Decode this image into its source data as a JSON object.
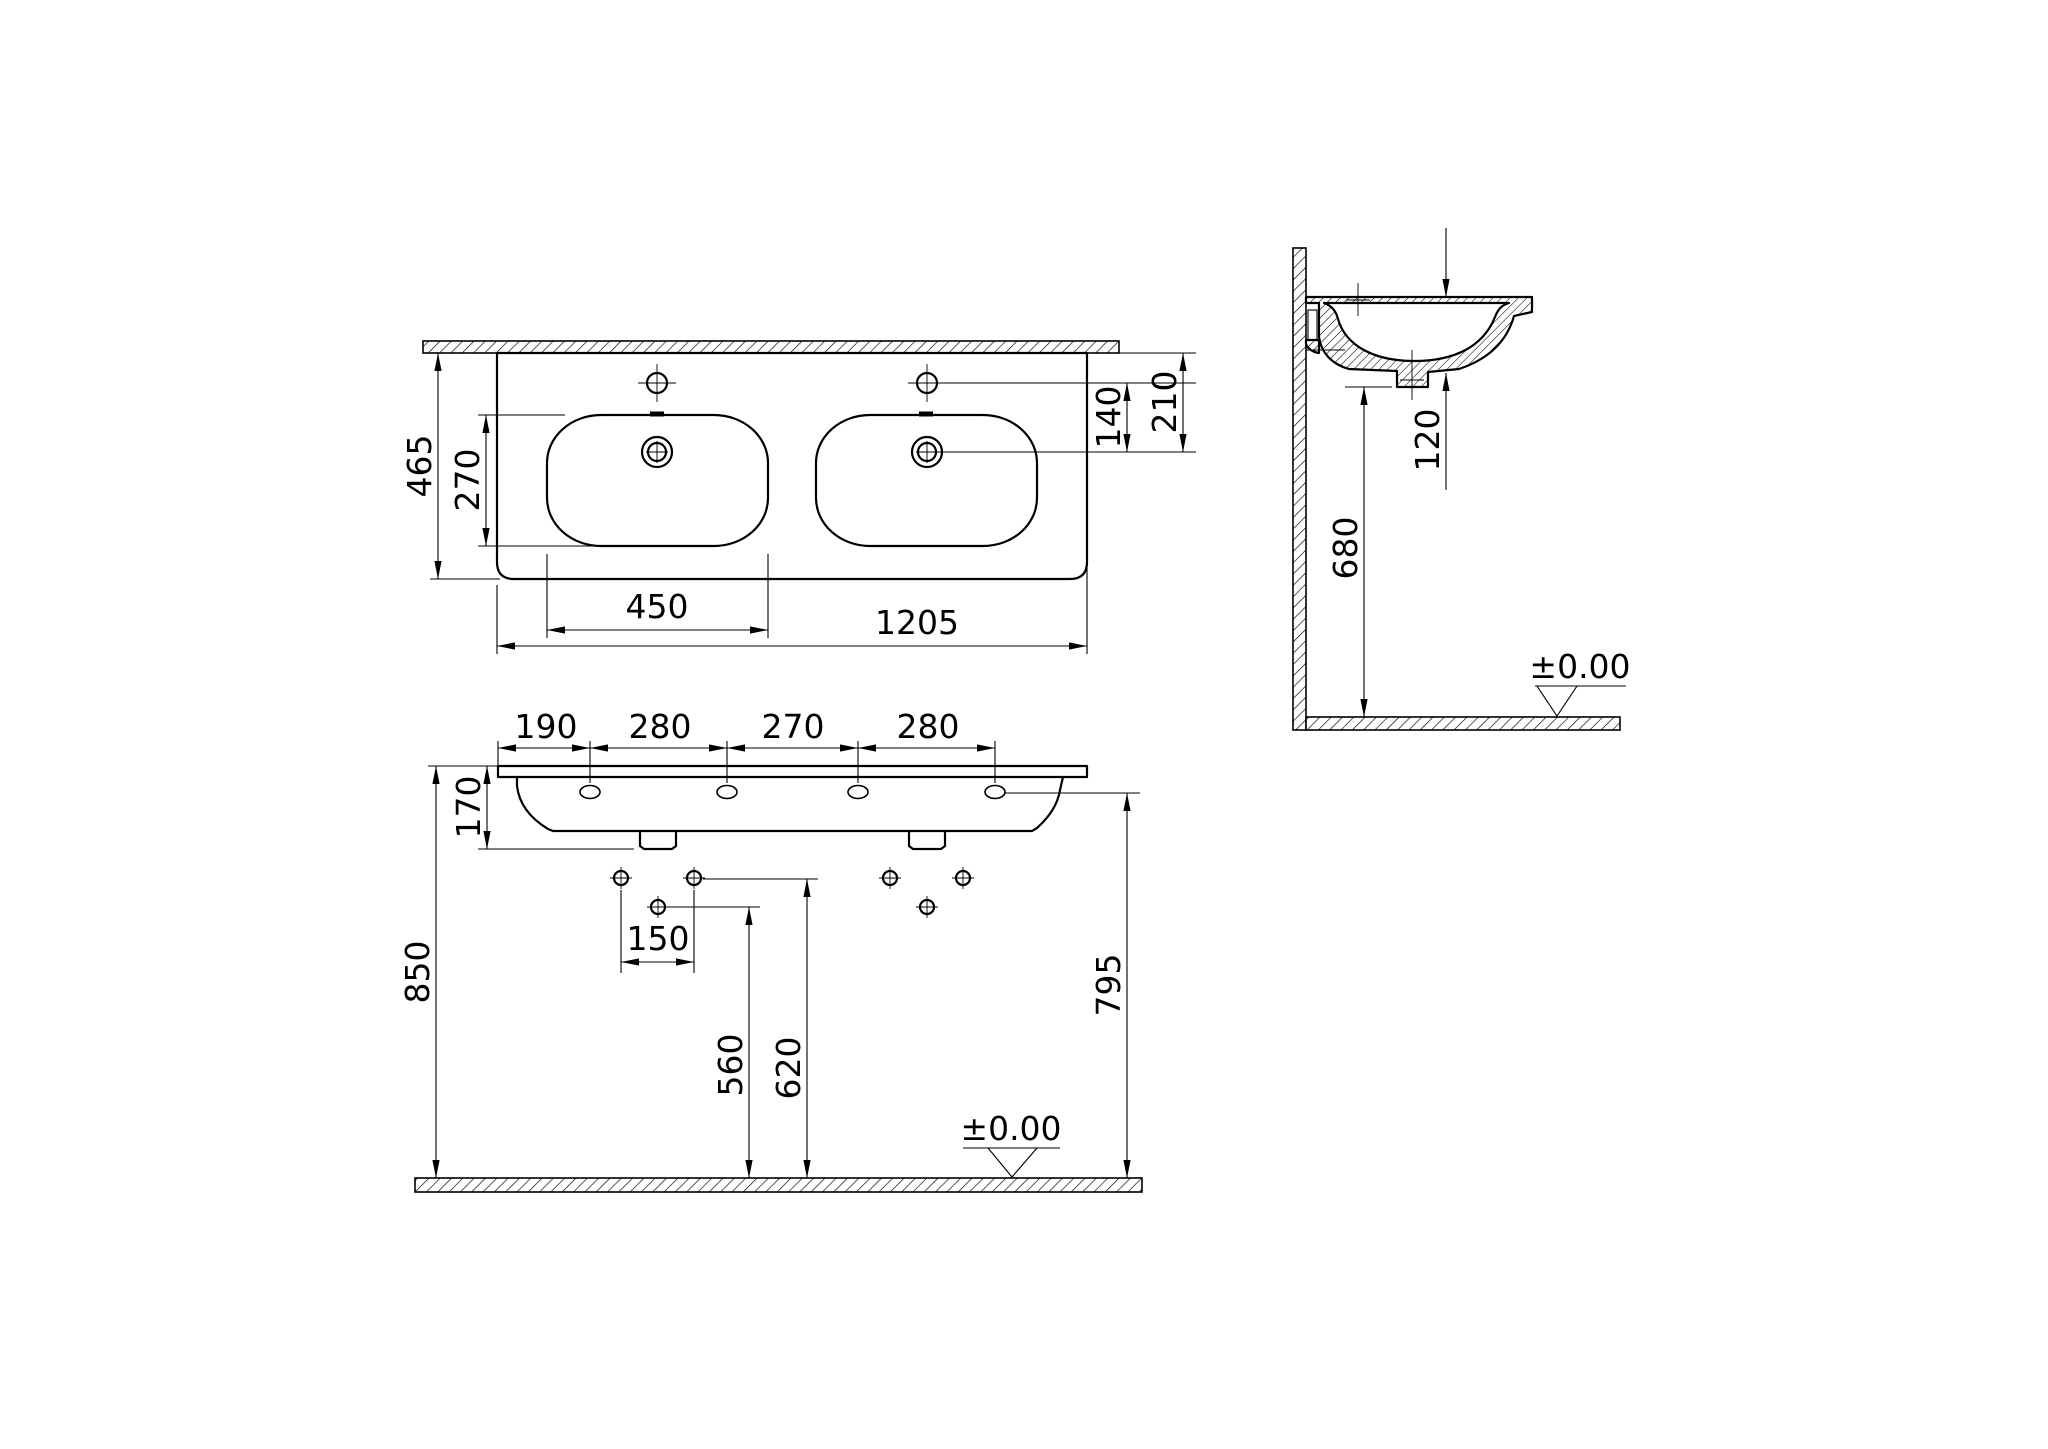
{
  "views": {
    "plan": {
      "overall_width": "1205",
      "overall_depth": "465",
      "bowl_width": "450",
      "bowl_depth": "270",
      "faucet_to_drain": "140",
      "rear_to_drain": "210"
    },
    "front": {
      "spacings": [
        "190",
        "280",
        "270",
        "280"
      ],
      "body_height": "170",
      "bolt_spacing": "150",
      "trap_height": "560",
      "fixing_height": "620",
      "rim_height": "850",
      "side_hole_height": "795",
      "floor_datum": "±0.00"
    },
    "side": {
      "basin_depth": "120",
      "underside_height": "680",
      "floor_datum": "±0.00"
    }
  }
}
